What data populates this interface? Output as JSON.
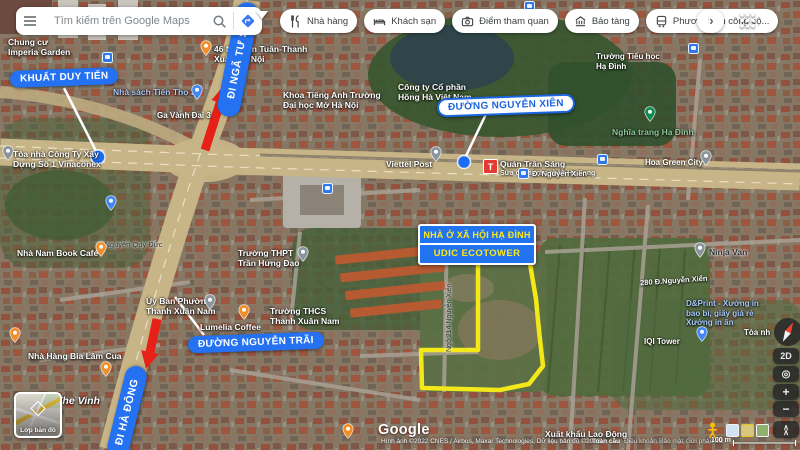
{
  "topbar": {
    "search_placeholder": "Tìm kiếm trên Google Maps",
    "chips": [
      {
        "label": "Nhà hàng",
        "icon": "restaurant-icon"
      },
      {
        "label": "Khách sạn",
        "icon": "hotel-icon"
      },
      {
        "label": "Điểm tham quan",
        "icon": "camera-icon"
      },
      {
        "label": "Bảo tàng",
        "icon": "museum-icon"
      },
      {
        "label": "Phương tiện công cộ...",
        "icon": "transit-icon"
      }
    ]
  },
  "annotations": {
    "khuat_duy_tien": "KHUẤT DUY TIẾN",
    "di_nga_tu_so": "ĐI NGÃ TƯ SỞ",
    "duong_nguyen_xien": "ĐƯỜNG NGUYỄN XIÊN",
    "duong_nguyen_trai": "ĐƯỜNG NGUYỄN TRÃI",
    "di_ha_dong": "ĐI HÀ ĐÔNG",
    "project_line1": "NHÀ Ở XÃ HỘI HẠ ĐÌNH",
    "project_line2": "UDIC ECOTOWER"
  },
  "labels": {
    "imperia": "Chung cư\nImperia Garden",
    "nguyen_tuan": "46 Nguyễn Tuân-Thanh\nXuân-Hà Nội",
    "nha_sach": "Nhà sách Tiến Thọ 3",
    "ga_vanh_dai": "Ga Vành Đai 3",
    "khoa_tieng_anh": "Khoa Tiếng Anh Trường\nĐại học Mở Hà Nội",
    "hong_ha": "Công ty Cổ phần\nHồng Hà Việt Nam",
    "truong_tieu_hoc": "Trường Tiểu học\nHạ Đình",
    "nghia_trang": "Nghĩa trang Hạ Đình",
    "viettel_post": "Viettel Post",
    "quan_tran_sang": "Quán Trần Sáng",
    "sua_chua": "Sữa chua trân châu Hạ Long",
    "nguyen_xien_street": "Đ. Nguyễn Xiển",
    "green_city": "Hoa Green City",
    "ninja_van": "Ninja Van",
    "d280": "280 Đ.Nguyễn Xiển",
    "dprint": "D&Print - Xưởng in\nbao bì, giấy giá rẻ\nXưởng in ấn",
    "toa_nha_partial": "Tòa nh",
    "iqi_tower": "IQI Tower",
    "thpt": "Trường THPT\nTrần Hưng Đạo",
    "thcs": "Trường THCS\nThanh Xuân Nam",
    "uy_ban": "Ủy Ban Phường\nThanh Xuân Nam",
    "lumelia": "Lumelia Coffee",
    "ngo_214": "Ngõ 214 Nguyễn Xiển",
    "vinaconex": "Tòa nhà Công Ty Xây\nDựng Số 1 Vinaconex",
    "nha_nam": "Nhà Nam Book Café",
    "nguyen_quy_duc": "Đ.Nguyễn Quý Đức",
    "bia_lam": "Nhà Hàng Bia Lâm Cua",
    "the_vinh": "The Vinh",
    "xuat_khau": "Xuất khẩu Lao Động"
  },
  "icons": {
    "viettel_t": "T",
    "menu": "hamburger-icon",
    "search": "search-icon",
    "directions": "directions-icon",
    "apps": "apps-grid-icon",
    "compass": "compass-icon",
    "pegman": "pegman-icon",
    "layers": "layers-icon"
  },
  "controls": {
    "twod": "2D",
    "zoom_in": "+",
    "zoom_out": "−",
    "layers_label": "Lớp bản đồ"
  },
  "footer": {
    "logo": "Google",
    "attribution": "Hình ảnh ©2022 CNES / Airbus, Maxar Technologies, Dữ liệu bản đồ ©2022",
    "link_global": "Toàn cầu",
    "link_terms": "Điều khoản",
    "link_privacy": "Bảo mật",
    "link_feedback": "Gửi phản hồi",
    "scale": "100 m"
  },
  "colors": {
    "accent_blue": "#1a73e8",
    "annotation_blue": "#2472f2",
    "highlight_yellow": "#f4e918",
    "arrow_red": "#e62117",
    "project_text_yellow": "#ffe81a"
  }
}
